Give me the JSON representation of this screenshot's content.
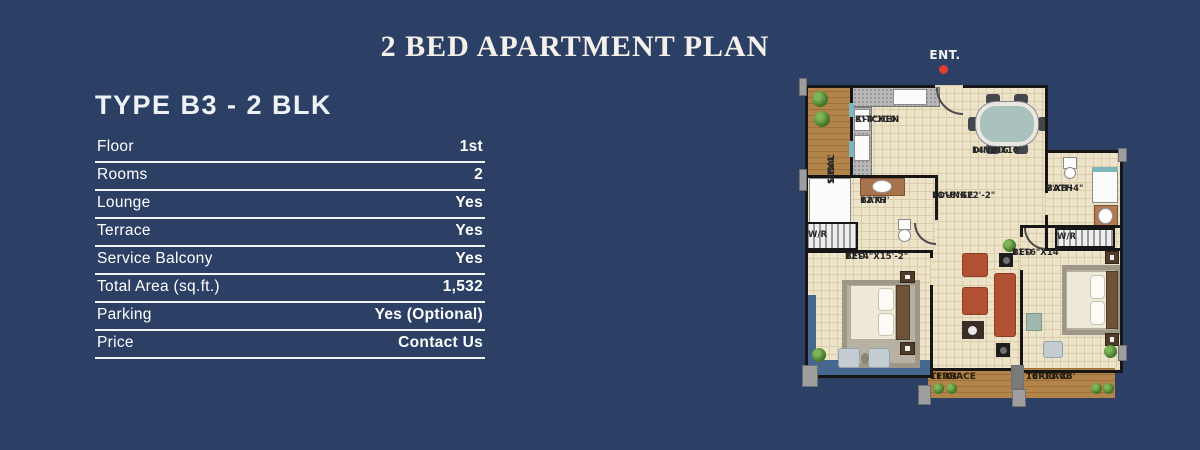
{
  "page": {
    "title": "2 BED APARTMENT PLAN",
    "background_color": "#2c4066",
    "accent_red": "#e03c31"
  },
  "spec": {
    "heading": "TYPE B3 - 2 BLK",
    "rows": [
      {
        "label": "Floor",
        "value": "1st"
      },
      {
        "label": "Rooms",
        "value": "2"
      },
      {
        "label": "Lounge",
        "value": "Yes"
      },
      {
        "label": "Terrace",
        "value": "Yes"
      },
      {
        "label": "Service Balcony",
        "value": "Yes"
      },
      {
        "label": "Total Area (sq.ft.)",
        "value": "1,532"
      },
      {
        "label": "Parking",
        "value": "Yes (Optional)"
      },
      {
        "label": "Price",
        "value": "Contact Us"
      }
    ]
  },
  "floorplan": {
    "entrance_label": "ENT.",
    "rooms": {
      "sbal": {
        "name": "S.BAL",
        "dim": "10'X4'"
      },
      "kitchen": {
        "name": "KITCHEN",
        "dim": "8'-4\"X10'"
      },
      "dining": {
        "name": "DINING",
        "dim": "14'-2\"X10'"
      },
      "lounge": {
        "name": "LOUNGE",
        "dim": "11'-8\"X22'-2\""
      },
      "bath_left": {
        "name": "BATH",
        "dim": "12'X7'"
      },
      "bath_right": {
        "name": "BATH",
        "dim": "7'X8'-4\""
      },
      "bed_left": {
        "name": "BED",
        "dim": "12'-4\"X15'-2\""
      },
      "bed_right": {
        "name": "BED",
        "dim": "11'-6\"X14'"
      },
      "terrace_left": {
        "name": "TERRACE",
        "dim": "11'X3'"
      },
      "terrace_right": {
        "name": "TERRACE",
        "dim": "10'-11\"X3'"
      },
      "wr_left": {
        "name": "W/R"
      },
      "wr_right": {
        "name": "W/R"
      }
    }
  }
}
